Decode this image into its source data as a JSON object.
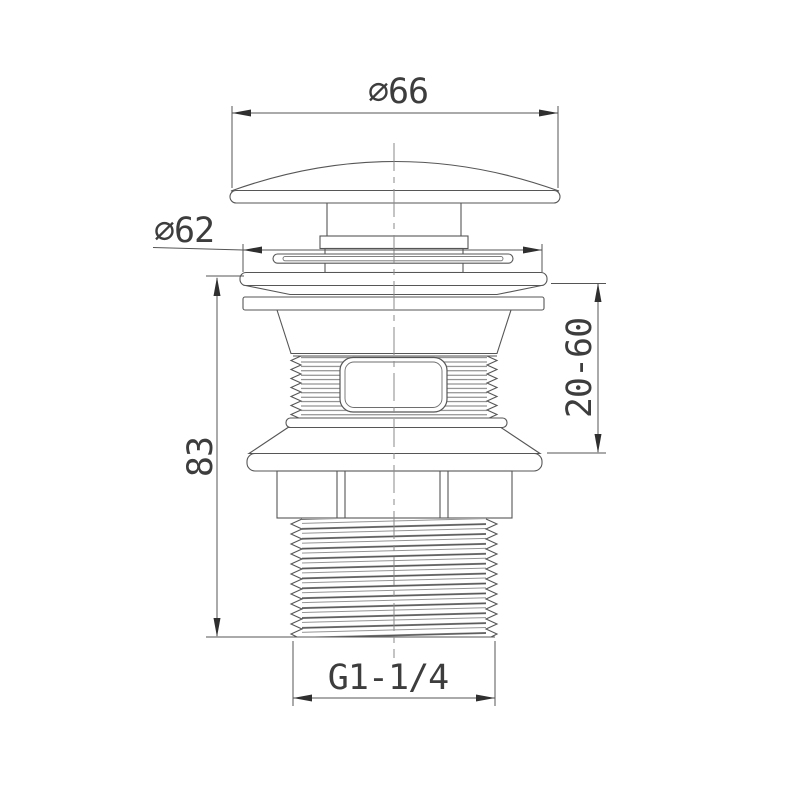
{
  "drawing": {
    "background": "#ffffff",
    "line_color": "#565656",
    "text_color": "#3d3d3d",
    "type": "technical-dimension-drawing",
    "subject": "pop-up basin waste valve side elevation",
    "labels": {
      "cap_diameter": "∅66",
      "flange_diameter": "∅62",
      "overall_height": "83",
      "clamping_range": "20-60",
      "thread_size": "G1-1/4"
    }
  }
}
